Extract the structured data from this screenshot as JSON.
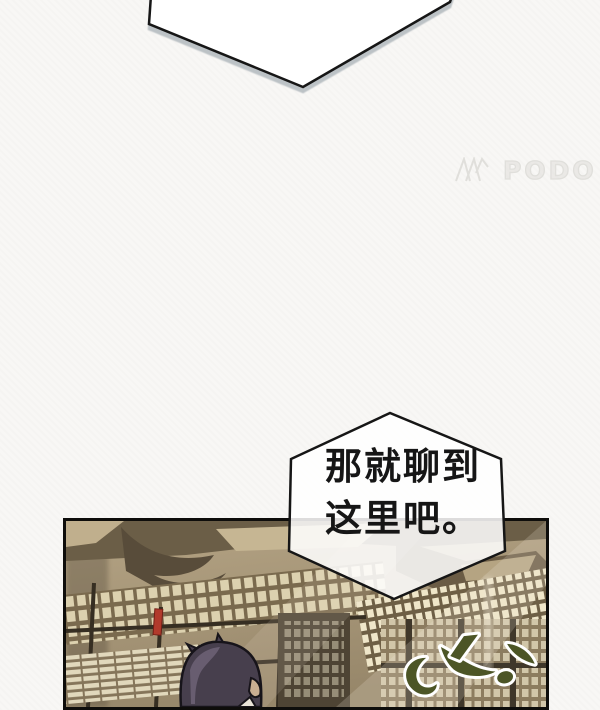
{
  "page": {
    "background_color": "#f8f7f5"
  },
  "watermark": {
    "text": "PODO",
    "color": "#deddd9"
  },
  "bubbles": {
    "top": {
      "fill": "#ffffff",
      "border_color": "#161616",
      "shadow_color": "#b2b8bd"
    },
    "middle": {
      "line1": "那就聊到",
      "line2": "这里吧。",
      "fill": "#ffffff",
      "border_color": "#161616",
      "text_color": "#161616"
    }
  },
  "panel": {
    "border_color": "#0e0d0b",
    "scene": "ancient-library-interior",
    "palette": {
      "base_tan": "#ac9b7d",
      "beam_dark": "#6b5e47",
      "slip_light": "#e9dfc2",
      "bright_haze": "#f0e8d5",
      "red_scroll": "#b23a2c",
      "hair": "#473f4d",
      "hair_highlight": "#6c6174",
      "skin": "#c9ae92",
      "sfx_fill": "#4c5526",
      "sfx_outline": "#ffffff"
    }
  }
}
